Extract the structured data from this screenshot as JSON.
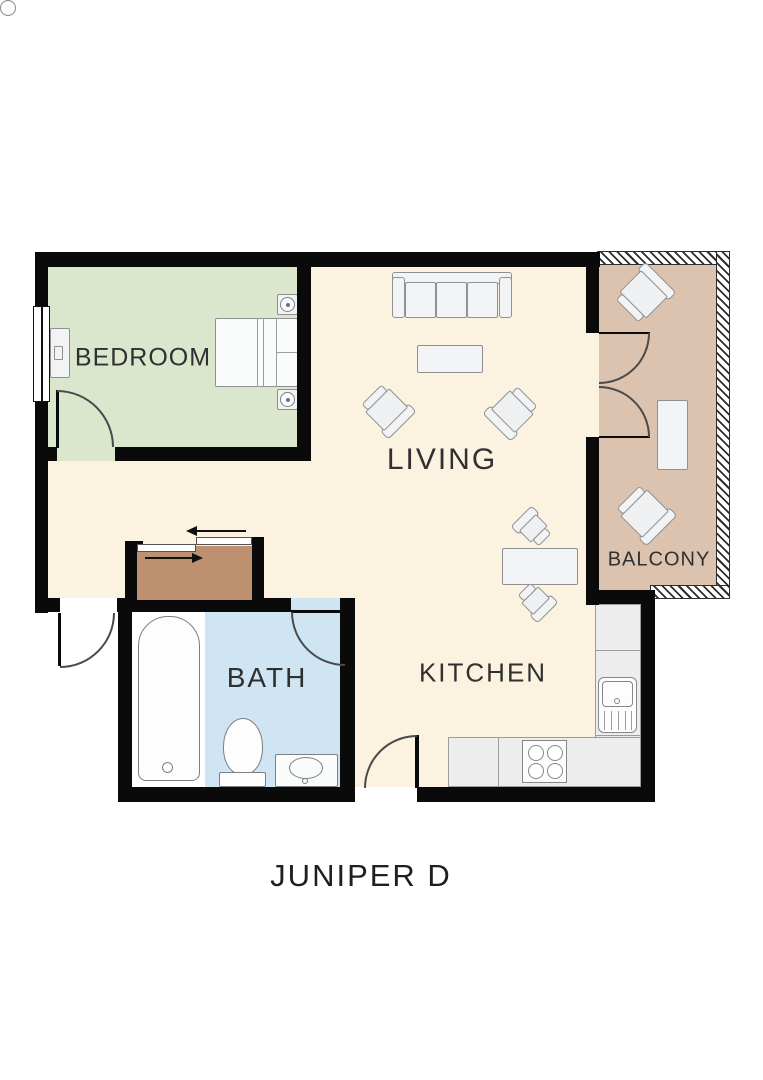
{
  "title": "JUNIPER D",
  "rooms": {
    "bedroom": {
      "label": "BEDROOM"
    },
    "living": {
      "label": "LIVING"
    },
    "balcony": {
      "label": "BALCONY"
    },
    "bath": {
      "label": "BATH"
    },
    "kitchen": {
      "label": "KITCHEN"
    }
  },
  "colors": {
    "wall": "#0a0a0a",
    "living_floor": "#fbf2df",
    "bedroom_floor": "#dbe7cd",
    "balcony_floor": "#dcc3b0",
    "bath_floor": "#cfe5f4",
    "tub_zone": "#ffffff",
    "closet_floor": "#bd9070",
    "counter_fill": "#ededee",
    "furniture_fill": "#f2f3f4",
    "furniture_border": "#8e9092",
    "label_text": "#303030"
  }
}
